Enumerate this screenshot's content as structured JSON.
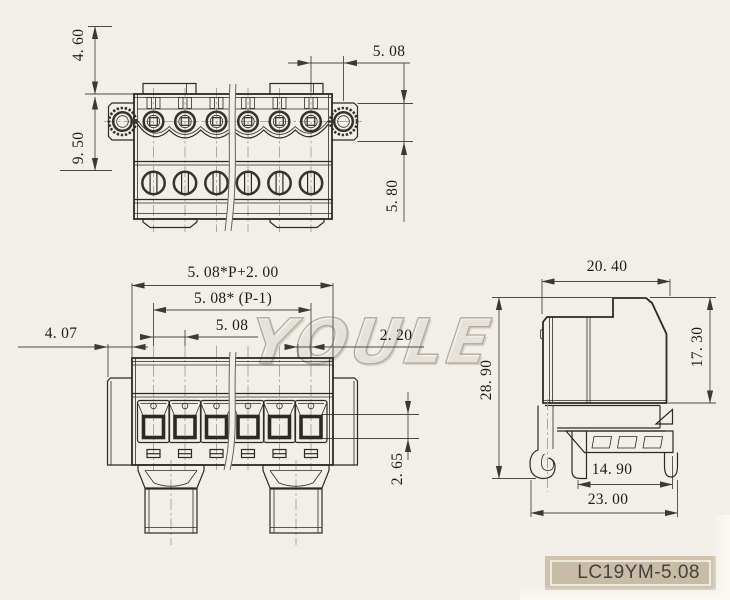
{
  "watermark": {
    "text": "YOULE"
  },
  "title_block": {
    "part_number": "LC19YM-5.08"
  },
  "dims": {
    "front": {
      "tab_height": "4. 60",
      "screw_pitch": "5. 08",
      "body_height": "9. 50",
      "flange_height": "5. 80"
    },
    "bottom": {
      "total_width": "5. 08*P+2. 00",
      "pole_span": "5. 08* (P-1)",
      "pitch": "5. 08",
      "edge_margin": "4. 07",
      "slot_offset": "2. 20",
      "opening_height": "2. 65"
    },
    "side": {
      "depth": "20. 40",
      "body_height": "17. 30",
      "total_height": "28. 90",
      "rail_width": "14. 90",
      "total_depth": "23. 00"
    }
  }
}
